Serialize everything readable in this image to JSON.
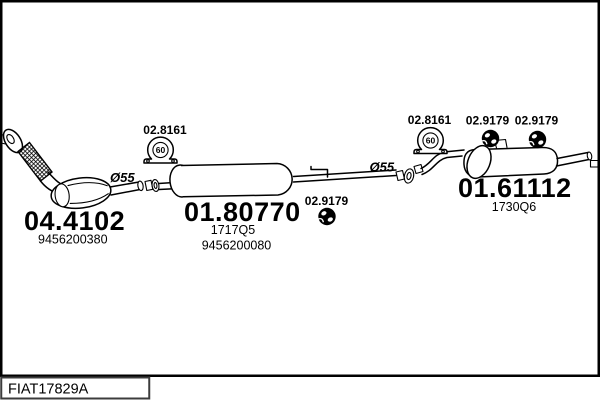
{
  "frame": {
    "footer_label": "FIAT17829A"
  },
  "colors": {
    "ink": "#000000",
    "background": "#ffffff"
  },
  "parts": {
    "catalyst": {
      "code": "04.4102",
      "ref": "9456200380"
    },
    "center_muffler": {
      "code": "01.80770",
      "type": "1717Q5",
      "ref": "9456200080"
    },
    "rear_muffler": {
      "code": "01.61112",
      "type": "1730Q6"
    }
  },
  "fittings": {
    "clamp_center": {
      "code": "02.8161",
      "size": "60"
    },
    "clamp_rear": {
      "code": "02.8161",
      "size": "60"
    },
    "hanger_center": {
      "code": "02.9179"
    },
    "hanger_rear_1": {
      "code": "02.9179"
    },
    "hanger_rear_2": {
      "code": "02.9179"
    }
  },
  "annotations": {
    "dia_front": "Ø55",
    "dia_rear": "Ø55"
  }
}
